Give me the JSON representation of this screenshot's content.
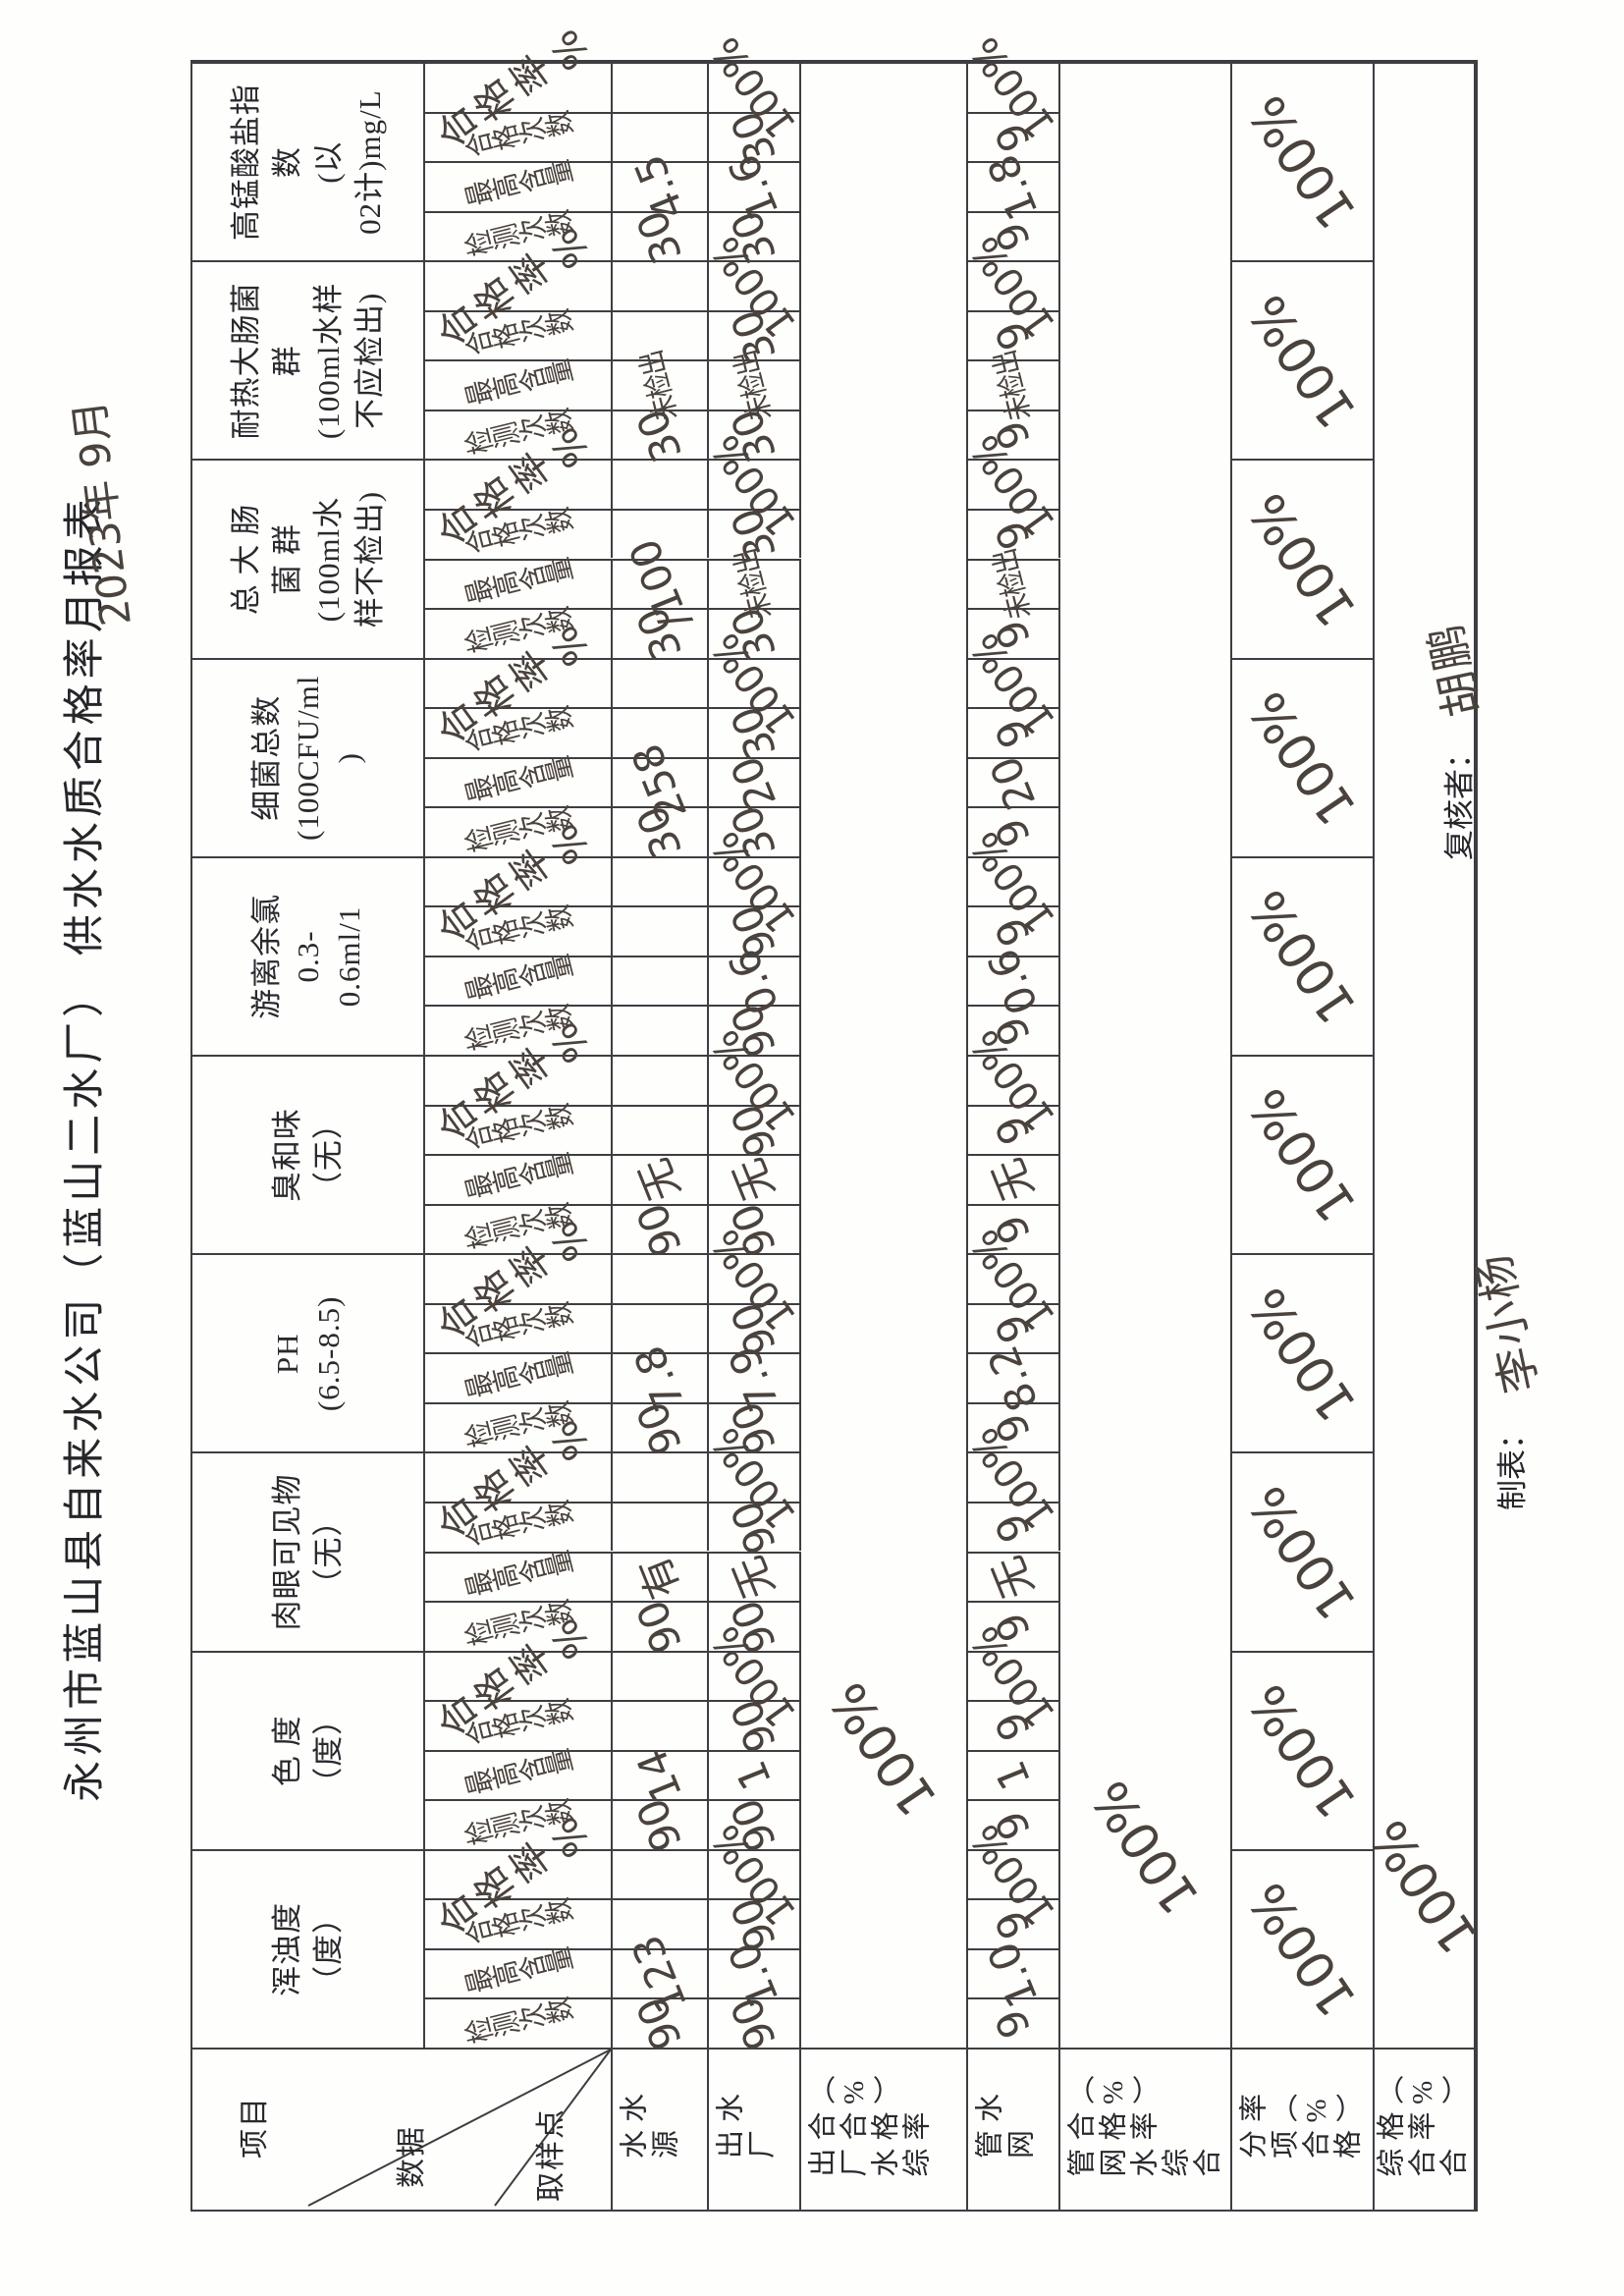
{
  "page": {
    "title": "永州市蓝山县自来水公司（蓝山二水厂） 供水水质合格率月报表",
    "date_note": "2023年 9月"
  },
  "corner": {
    "top_label": "项目",
    "mid_label": "数据",
    "bottom_label": "取样点"
  },
  "table": {
    "sub_headers": [
      "检测次数",
      "最高含量",
      "合格次数",
      "合格率%"
    ],
    "column_headers": [
      [
        "浑浊度",
        "（度）"
      ],
      [
        "色 度",
        "（度）"
      ],
      [
        "肉眼可见物",
        "（无）"
      ],
      [
        "PH",
        "(6.5-8.5)"
      ],
      [
        "臭和味",
        "（无）"
      ],
      [
        "游离余氯",
        "0.3-",
        "0.6ml/1"
      ],
      [
        "细菌总数",
        "(100CFU/ml",
        ")"
      ],
      [
        "总 大 肠",
        "菌 群",
        "(100ml水",
        "样不检出)"
      ],
      [
        "耐热大肠菌",
        "群",
        "(100ml水样",
        "不应检出)"
      ],
      [
        "高锰酸盐指",
        "数",
        "(以",
        "02计)mg/L"
      ]
    ],
    "row_labels": [
      "水源水",
      "出厂水",
      "出厂水综合合格率（%）",
      "管网水",
      "管网水综合合格率（%）",
      "分项合格率（%）",
      "综合合格率（%）"
    ],
    "source_water": [
      [
        "90",
        "123",
        "",
        ""
      ],
      [
        "90",
        "14",
        "",
        ""
      ],
      [
        "90",
        "有",
        "",
        ""
      ],
      [
        "90",
        "7.8",
        "",
        ""
      ],
      [
        "90",
        "无",
        "",
        ""
      ],
      [
        "",
        "",
        "",
        ""
      ],
      [
        "30",
        "258",
        "",
        ""
      ],
      [
        "30",
        "∕100",
        "",
        ""
      ],
      [
        "30",
        "未检出",
        "",
        ""
      ],
      [
        "30",
        "4.5",
        "",
        ""
      ]
    ],
    "plant_water": [
      [
        "90",
        "1.0",
        "90",
        "100%"
      ],
      [
        "90",
        "1",
        "90",
        "100%"
      ],
      [
        "90",
        "无",
        "90",
        "100%"
      ],
      [
        "90",
        "7.9",
        "90",
        "100%"
      ],
      [
        "90",
        "无",
        "90",
        "100%"
      ],
      [
        "90",
        "0.6",
        "90",
        "100%"
      ],
      [
        "30",
        "20",
        "30",
        "100%"
      ],
      [
        "30",
        "未检出",
        "30",
        "100%"
      ],
      [
        "30",
        "未检出",
        "30",
        "100%"
      ],
      [
        "30",
        "1.6",
        "30",
        "100%"
      ]
    ],
    "plant_overall": "100%",
    "network_water": [
      [
        "9",
        "1.0",
        "9",
        "100%"
      ],
      [
        "9",
        "1",
        "9",
        "100%"
      ],
      [
        "9",
        "无",
        "9",
        "100%"
      ],
      [
        "9",
        "8.2",
        "9",
        "100%"
      ],
      [
        "9",
        "无",
        "9",
        "100%"
      ],
      [
        "9",
        "0.6",
        "9",
        "100%"
      ],
      [
        "9",
        "20",
        "9",
        "100%"
      ],
      [
        "9",
        "未检出",
        "9",
        "100%"
      ],
      [
        "9",
        "未检出",
        "9",
        "100%"
      ],
      [
        "9",
        "1.8",
        "9",
        "100%"
      ]
    ],
    "network_overall": "100%",
    "item_rates": [
      "100%",
      "100%",
      "100%",
      "100%",
      "100%",
      "100%",
      "100%",
      "100%",
      "100%",
      "100%"
    ],
    "overall_rate": "100%"
  },
  "footer": {
    "maker_label": "制表：",
    "maker_signature": "李小杨",
    "reviewer_label": "复核者：",
    "reviewer_signature": "胡鹏"
  },
  "colors": {
    "ink": "#2a2a2e",
    "handwriting": "#4a423c",
    "line": "#3e3e42",
    "paper": "#fefefd"
  }
}
